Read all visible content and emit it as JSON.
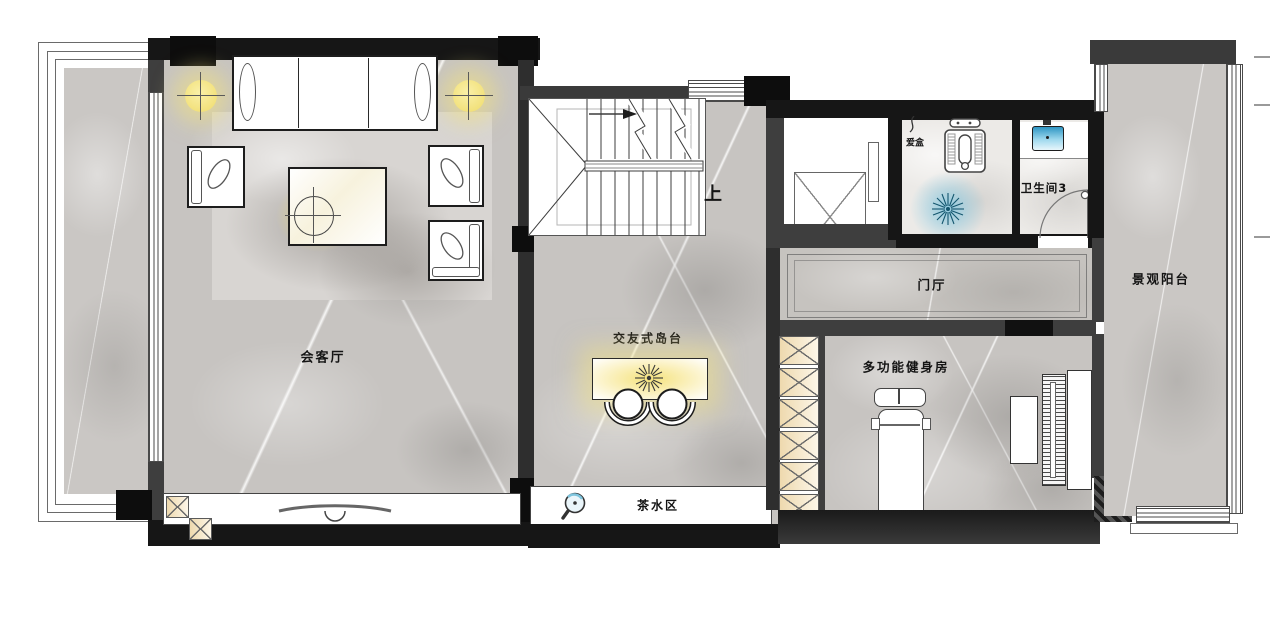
{
  "rooms": {
    "living": {
      "label": "会客厅"
    },
    "island": {
      "label": "交友式岛台"
    },
    "tea": {
      "label": "茶水区"
    },
    "foyer": {
      "label": "门厅"
    },
    "bath3": {
      "label": "卫生间3"
    },
    "gym": {
      "label": "多功能健身房"
    },
    "balcony": {
      "label": "景观阳台"
    }
  },
  "annotations": {
    "stairs_up": "上",
    "laundry_box": "爱盒"
  },
  "colors": {
    "wall_black": "#161616",
    "wall_gray": "#3e3e3e",
    "floor_stone": "#c7c4c1",
    "floor_tile": "#eceae7",
    "light_yellow": "#f3e07c",
    "cabinet_tan": "#eed9ae",
    "water_blue": "#2f9cc7"
  }
}
